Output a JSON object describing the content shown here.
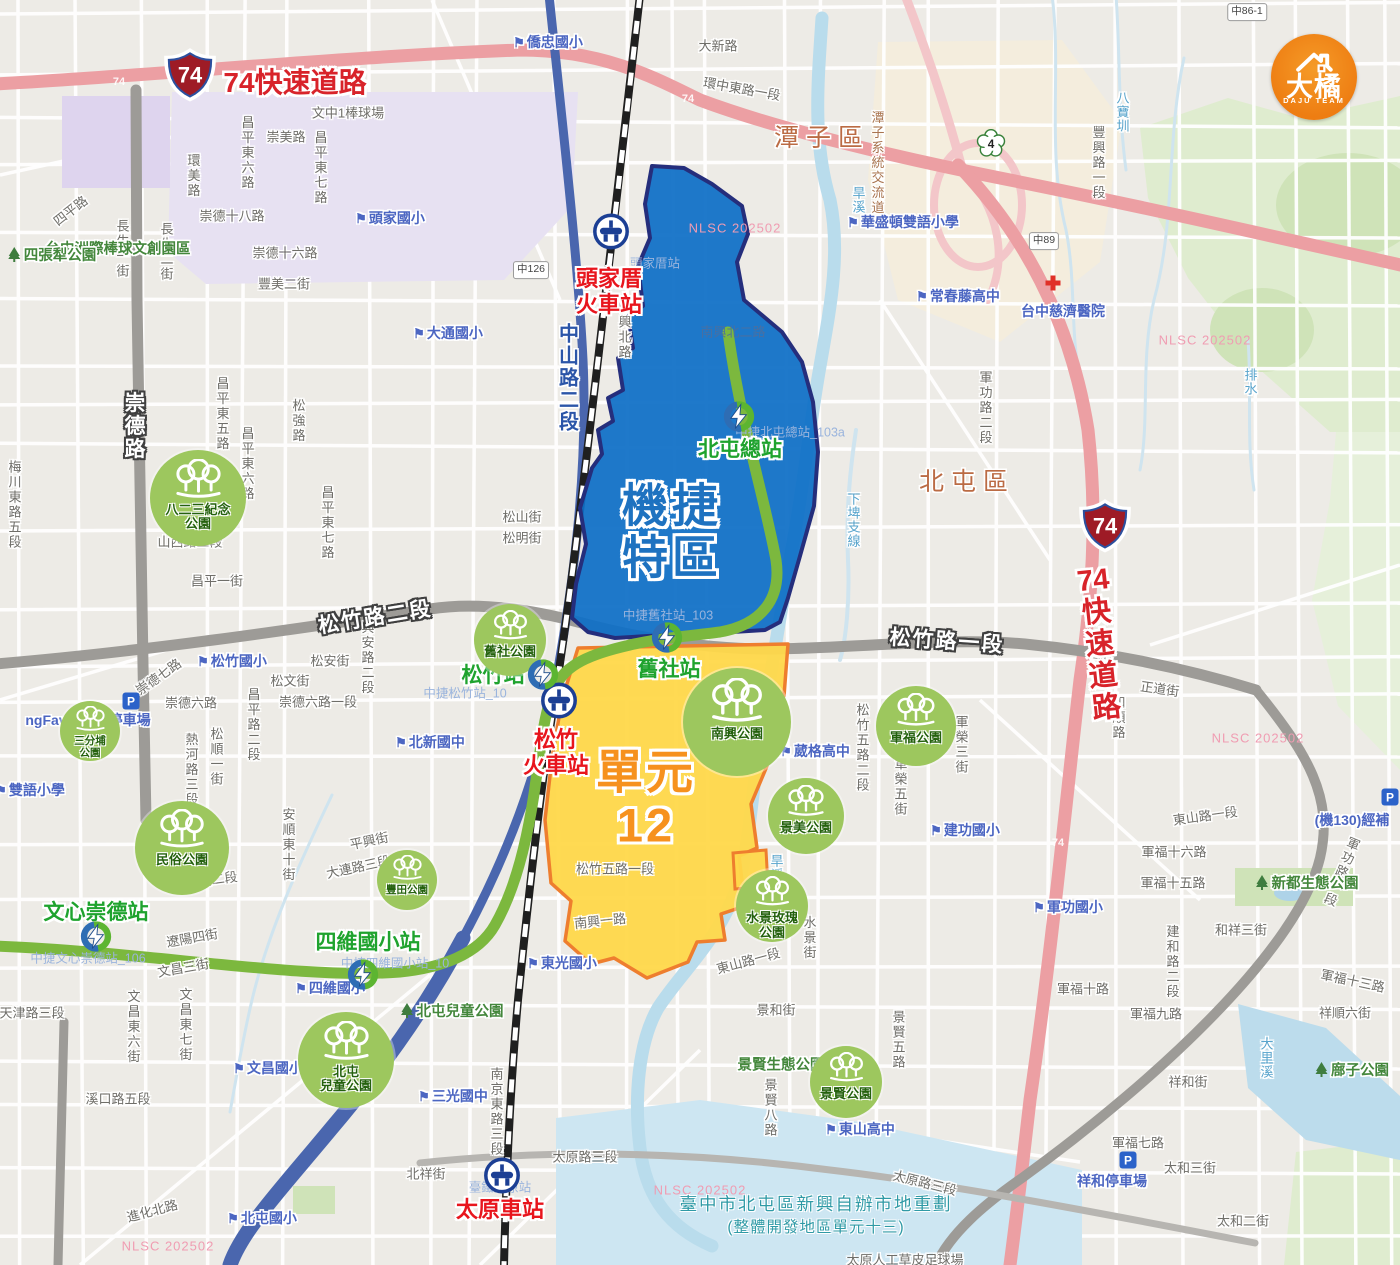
{
  "canvas": {
    "w": 1400,
    "h": 1265
  },
  "logo": {
    "title": "大橘",
    "subtitle": "DAJU TEAM"
  },
  "zones": {
    "jiejie": {
      "line1": "機捷",
      "line2": "特區"
    },
    "unit12": {
      "line1": "單元",
      "line2": "12"
    }
  },
  "expressway": {
    "shield": "74",
    "top_label": "74快速道路",
    "right_label_chars": [
      "74",
      "快",
      "速",
      "道",
      "路"
    ],
    "road_markers": [
      {
        "t": "74",
        "x": 119,
        "y": 82
      },
      {
        "t": "74",
        "x": 688,
        "y": 99
      },
      {
        "t": "74",
        "x": 1058,
        "y": 843
      }
    ]
  },
  "shields": {
    "s74": [
      {
        "x": 190,
        "y": 77
      },
      {
        "x": 1105,
        "y": 528
      }
    ],
    "route4": {
      "label": "4",
      "x": 991,
      "y": 146
    }
  },
  "marker_boxes": [
    {
      "t": "中86-1",
      "x": 1247,
      "y": 12
    },
    {
      "t": "中126",
      "x": 531,
      "y": 270
    },
    {
      "t": "中89",
      "x": 1044,
      "y": 241
    }
  ],
  "districts": [
    {
      "t": "潭子區",
      "x": 822,
      "y": 136
    },
    {
      "t": "北屯區",
      "x": 967,
      "y": 480
    }
  ],
  "tra_stations": [
    {
      "name": "頭家厝火車站",
      "lines": [
        "頭家厝",
        "火車站"
      ],
      "icon": {
        "x": 611,
        "y": 234
      },
      "label": {
        "x": 609,
        "y": 292
      }
    },
    {
      "name": "松竹火車站",
      "lines": [
        "松竹",
        "火車站"
      ],
      "icon": {
        "x": 559,
        "y": 703
      },
      "label": {
        "x": 556,
        "y": 753
      }
    },
    {
      "name": "太原車站",
      "lines": [
        "太原車站"
      ],
      "icon": {
        "x": 502,
        "y": 1178
      },
      "label": {
        "x": 500,
        "y": 1210
      }
    }
  ],
  "mrt_stations": [
    {
      "name": "北屯總站",
      "icon": {
        "x": 739,
        "y": 419
      },
      "label": {
        "x": 740,
        "y": 448
      }
    },
    {
      "name": "舊社站",
      "icon": {
        "x": 667,
        "y": 640
      },
      "label": {
        "x": 669,
        "y": 668
      }
    },
    {
      "name": "松竹站",
      "icon": {
        "x": 543,
        "y": 677
      },
      "label": {
        "x": 493,
        "y": 674
      }
    },
    {
      "name": "文心崇德站",
      "icon": {
        "x": 96,
        "y": 939
      },
      "label": {
        "x": 96,
        "y": 911
      }
    },
    {
      "name": "四維國小站",
      "icon": {
        "x": 363,
        "y": 977
      },
      "label": {
        "x": 368,
        "y": 941
      }
    }
  ],
  "parks": [
    {
      "lines": [
        "八二三紀念",
        "公園"
      ],
      "x": 198,
      "y": 498,
      "r": 48
    },
    {
      "lines": [
        "三分埔",
        "公園"
      ],
      "x": 90,
      "y": 731,
      "r": 30
    },
    {
      "lines": [
        "民俗公園"
      ],
      "x": 182,
      "y": 848,
      "r": 47
    },
    {
      "lines": [
        "豐田公園"
      ],
      "x": 407,
      "y": 880,
      "r": 30
    },
    {
      "lines": [
        "舊社公園"
      ],
      "x": 510,
      "y": 640,
      "r": 36
    },
    {
      "lines": [
        "南興公園"
      ],
      "x": 737,
      "y": 722,
      "r": 54
    },
    {
      "lines": [
        "軍福公園"
      ],
      "x": 916,
      "y": 726,
      "r": 40
    },
    {
      "lines": [
        "景美公園"
      ],
      "x": 806,
      "y": 816,
      "r": 38
    },
    {
      "lines": [
        "水景玫瑰",
        "公園"
      ],
      "x": 772,
      "y": 906,
      "r": 36
    },
    {
      "lines": [
        "景賢公園"
      ],
      "x": 846,
      "y": 1082,
      "r": 36
    },
    {
      "lines": [
        "北屯",
        "兒童公園"
      ],
      "x": 346,
      "y": 1060,
      "r": 48
    }
  ],
  "road_labels": [
    {
      "t": "大新路",
      "x": 718,
      "y": 45
    },
    {
      "t": "環中東路一段",
      "x": 742,
      "y": 88,
      "r": 10
    },
    {
      "t": "崇美路",
      "x": 286,
      "y": 136
    },
    {
      "t": "文中1棒球場",
      "x": 348,
      "y": 112
    },
    {
      "t": "昌平東七路",
      "x": 320,
      "y": 168,
      "v": 1
    },
    {
      "t": "昌平東六路",
      "x": 247,
      "y": 153,
      "v": 1
    },
    {
      "t": "環美路",
      "x": 193,
      "y": 176,
      "v": 1
    },
    {
      "t": "四平路",
      "x": 70,
      "y": 210,
      "r": -38
    },
    {
      "t": "崇德十八路",
      "x": 232,
      "y": 215
    },
    {
      "t": "長生一街",
      "x": 122,
      "y": 249,
      "v": 1
    },
    {
      "t": "長生二街",
      "x": 166,
      "y": 252,
      "v": 1
    },
    {
      "t": "崇德十六路",
      "x": 285,
      "y": 252
    },
    {
      "t": "豐美二街",
      "x": 284,
      "y": 283
    },
    {
      "t": "梅川東路五段",
      "x": 14,
      "y": 505,
      "v": 1
    },
    {
      "t": "昌平東五路",
      "x": 222,
      "y": 414,
      "v": 1
    },
    {
      "t": "昌平東六路",
      "x": 247,
      "y": 464,
      "v": 1
    },
    {
      "t": "松強路",
      "x": 298,
      "y": 421,
      "v": 1
    },
    {
      "t": "昌平東七路",
      "x": 327,
      "y": 523,
      "v": 1
    },
    {
      "t": "山西路三段",
      "x": 190,
      "y": 541
    },
    {
      "t": "昌平一街",
      "x": 217,
      "y": 580
    },
    {
      "t": "松山街",
      "x": 522,
      "y": 516
    },
    {
      "t": "松明街",
      "x": 522,
      "y": 537
    },
    {
      "t": "中興北路",
      "x": 624,
      "y": 330,
      "v": 1
    },
    {
      "t": "南興北二路",
      "x": 733,
      "y": 331,
      "cls": "inblue"
    },
    {
      "t": "崇德七路",
      "x": 158,
      "y": 676,
      "r": -35
    },
    {
      "t": "崇德六路",
      "x": 191,
      "y": 702
    },
    {
      "t": "崇德六路一段",
      "x": 318,
      "y": 701
    },
    {
      "t": "松文街",
      "x": 290,
      "y": 680
    },
    {
      "t": "松安街",
      "x": 330,
      "y": 660
    },
    {
      "t": "興安路二段",
      "x": 367,
      "y": 658,
      "v": 1
    },
    {
      "t": "昌平路二段",
      "x": 253,
      "y": 725,
      "v": 1
    },
    {
      "t": "熱河路三段",
      "x": 191,
      "y": 770,
      "v": 1
    },
    {
      "t": "松順一街",
      "x": 216,
      "y": 757,
      "v": 1
    },
    {
      "t": "安順東十街",
      "x": 288,
      "y": 845,
      "v": 1
    },
    {
      "t": "平興街",
      "x": 369,
      "y": 840,
      "r": -12
    },
    {
      "t": "大連路三段",
      "x": 358,
      "y": 866,
      "r": -12
    },
    {
      "t": "旅順路二段",
      "x": 205,
      "y": 880,
      "r": -8
    },
    {
      "t": "遼陽四街",
      "x": 192,
      "y": 937,
      "r": -10
    },
    {
      "t": "文昌三街",
      "x": 183,
      "y": 967,
      "r": -10
    },
    {
      "t": "文昌東六街",
      "x": 133,
      "y": 1027,
      "v": 1
    },
    {
      "t": "文昌東七街",
      "x": 185,
      "y": 1025,
      "v": 1
    },
    {
      "t": "天津路三段",
      "x": 32,
      "y": 1012
    },
    {
      "t": "溪口路五段",
      "x": 118,
      "y": 1098
    },
    {
      "t": "進化北路",
      "x": 152,
      "y": 1210,
      "r": -15
    },
    {
      "t": "北祥街",
      "x": 426,
      "y": 1173
    },
    {
      "t": "南京東路三段",
      "x": 496,
      "y": 1112,
      "v": 1
    },
    {
      "t": "太原路三段",
      "x": 585,
      "y": 1156
    },
    {
      "t": "太原路三段",
      "x": 925,
      "y": 1182,
      "r": 14
    },
    {
      "t": "太原人工草皮足球場",
      "x": 905,
      "y": 1259
    },
    {
      "t": "東山路一段",
      "x": 748,
      "y": 960,
      "r": -15
    },
    {
      "t": "水景街",
      "x": 809,
      "y": 938,
      "v": 1
    },
    {
      "t": "景和街",
      "x": 776,
      "y": 1009
    },
    {
      "t": "東山路一段",
      "x": 1205,
      "y": 815,
      "r": -8
    },
    {
      "t": "軍福十六路",
      "x": 1174,
      "y": 851
    },
    {
      "t": "軍福十五路",
      "x": 1173,
      "y": 882
    },
    {
      "t": "和祥三街",
      "x": 1241,
      "y": 929
    },
    {
      "t": "建和路二段",
      "x": 1172,
      "y": 962,
      "v": 1
    },
    {
      "t": "軍福十路",
      "x": 1083,
      "y": 988
    },
    {
      "t": "軍福九路",
      "x": 1156,
      "y": 1013
    },
    {
      "t": "軍福十三路",
      "x": 1353,
      "y": 980,
      "r": 12
    },
    {
      "t": "祥順六街",
      "x": 1345,
      "y": 1012
    },
    {
      "t": "景賢五路",
      "x": 898,
      "y": 1040,
      "v": 1
    },
    {
      "t": "景賢八路",
      "x": 770,
      "y": 1108,
      "v": 1
    },
    {
      "t": "軍功路一段",
      "x": 1341,
      "y": 872,
      "v": 1,
      "r": 22
    },
    {
      "t": "祥和街",
      "x": 1188,
      "y": 1081
    },
    {
      "t": "軍福七路",
      "x": 1138,
      "y": 1142
    },
    {
      "t": "太和三街",
      "x": 1190,
      "y": 1167
    },
    {
      "t": "太和二街",
      "x": 1243,
      "y": 1220
    },
    {
      "t": "松竹五路二段",
      "x": 862,
      "y": 748,
      "v": 1
    },
    {
      "t": "松竹五路一段",
      "x": 615,
      "y": 868
    },
    {
      "t": "南興一路",
      "x": 600,
      "y": 920,
      "r": -6
    },
    {
      "t": "軍榮三街",
      "x": 961,
      "y": 745,
      "v": 1
    },
    {
      "t": "軍榮五街",
      "x": 900,
      "y": 787,
      "v": 1
    },
    {
      "t": "正道街",
      "x": 1160,
      "y": 688,
      "r": 8
    },
    {
      "t": "和順路",
      "x": 1118,
      "y": 718,
      "v": 1
    },
    {
      "t": "軍功路二段",
      "x": 985,
      "y": 408,
      "v": 1
    },
    {
      "t": "豐興路一段",
      "x": 1098,
      "y": 163,
      "v": 1
    },
    {
      "t": "潭子系統交流道",
      "x": 877,
      "y": 163,
      "v": 1,
      "cls": "brown"
    },
    {
      "t": "崇德路",
      "x": 133,
      "y": 426,
      "v": 1,
      "cls": "major"
    },
    {
      "t": "松竹路二段",
      "x": 375,
      "y": 616,
      "r": -9,
      "cls": "major"
    },
    {
      "t": "松竹路一段",
      "x": 947,
      "y": 640,
      "r": 4,
      "cls": "major"
    },
    {
      "t": "中山路二段",
      "x": 567,
      "y": 378,
      "v": 1,
      "cls": "blueroad"
    }
  ],
  "school_labels": [
    {
      "t": "僑忠國小",
      "x": 548,
      "y": 42
    },
    {
      "t": "頭家國小",
      "x": 390,
      "y": 218
    },
    {
      "t": "大通國小",
      "x": 448,
      "y": 333
    },
    {
      "t": "華盛頓雙語小學",
      "x": 903,
      "y": 222
    },
    {
      "t": "常春藤高中",
      "x": 958,
      "y": 296
    },
    {
      "t": "雙語小學",
      "x": 30,
      "y": 790
    },
    {
      "t": "松竹國小",
      "x": 232,
      "y": 661
    },
    {
      "t": "北新國中",
      "x": 430,
      "y": 742
    },
    {
      "t": "四維國小",
      "x": 330,
      "y": 988
    },
    {
      "t": "文昌國小",
      "x": 268,
      "y": 1068
    },
    {
      "t": "三光國中",
      "x": 453,
      "y": 1096
    },
    {
      "t": "北屯國小",
      "x": 262,
      "y": 1218
    },
    {
      "t": "東光國小",
      "x": 562,
      "y": 963
    },
    {
      "t": "葳格高中",
      "x": 815,
      "y": 751
    },
    {
      "t": "建功國小",
      "x": 965,
      "y": 830
    },
    {
      "t": "東山高中",
      "x": 860,
      "y": 1129
    },
    {
      "t": "軍功國小",
      "x": 1068,
      "y": 907
    }
  ],
  "blue_plain_labels": [
    {
      "t": "ngFavor松竹停車場",
      "x": 88,
      "y": 720
    },
    {
      "t": "(機130)經補",
      "x": 1352,
      "y": 820
    },
    {
      "t": "祥和停車場",
      "x": 1112,
      "y": 1181
    }
  ],
  "water_labels": [
    {
      "t": "旱溪",
      "x": 858,
      "y": 200,
      "v": 1
    },
    {
      "t": "旱溪",
      "x": 776,
      "y": 868,
      "v": 1
    },
    {
      "t": "八寶圳",
      "x": 1122,
      "y": 112,
      "v": 1
    },
    {
      "t": "下埤支線",
      "x": 853,
      "y": 520,
      "v": 1
    },
    {
      "t": "大里溪",
      "x": 1266,
      "y": 1058,
      "v": 1
    },
    {
      "t": "排水",
      "x": 1250,
      "y": 382,
      "v": 1
    }
  ],
  "green_labels": [
    {
      "t": "台中洲際棒球文創園區",
      "x": 118,
      "y": 248
    },
    {
      "t": "四張犁公園",
      "x": 52,
      "y": 255,
      "tree": 1
    },
    {
      "t": "北屯兒童公園",
      "x": 452,
      "y": 1011,
      "tree": 1
    },
    {
      "t": "新都生態公園",
      "x": 1307,
      "y": 883,
      "tree": 1
    },
    {
      "t": "景賢生態公園",
      "x": 781,
      "y": 1064
    },
    {
      "t": "廍子公園",
      "x": 1352,
      "y": 1070,
      "tree": 1
    }
  ],
  "faint_labels": [
    {
      "t": "頭家厝站",
      "x": 655,
      "y": 262
    },
    {
      "t": "中捷北屯總站_103a",
      "x": 790,
      "y": 431
    },
    {
      "t": "中捷舊社站_103",
      "x": 668,
      "y": 614
    },
    {
      "t": "中捷松竹站_10",
      "x": 465,
      "y": 692
    },
    {
      "t": "臺鐵太原站",
      "x": 500,
      "y": 1186
    },
    {
      "t": "中捷文心崇德站_106",
      "x": 88,
      "y": 957
    },
    {
      "t": "中捷四維國小站_10",
      "x": 395,
      "y": 962
    }
  ],
  "parking_label": "P",
  "parking_markers": [
    {
      "x": 131,
      "y": 701
    },
    {
      "x": 1390,
      "y": 797
    },
    {
      "x": 1128,
      "y": 1160
    }
  ],
  "hospital": {
    "name": "台中慈濟醫院",
    "x": 1063,
    "y": 311,
    "cross_x": 1053,
    "cross_y": 283
  },
  "note": {
    "line1": "臺中市北屯區新興自辦市地重劃",
    "line2": "(整體開發地區單元十三)"
  },
  "watermark": {
    "text": "NLSC 202502",
    "positions": [
      {
        "x": 735,
        "y": 228
      },
      {
        "x": 1205,
        "y": 340
      },
      {
        "x": 1258,
        "y": 738
      },
      {
        "x": 700,
        "y": 1190
      },
      {
        "x": 168,
        "y": 1246
      }
    ]
  }
}
